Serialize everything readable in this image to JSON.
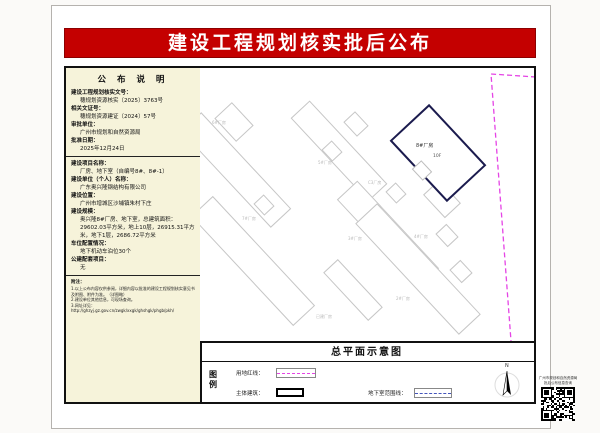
{
  "page": {
    "title": "建设工程规划核实批后公布"
  },
  "colors": {
    "banner_red": "#c40000",
    "panel_beige": "#f6f3da",
    "boundary_magenta": "#e544e5",
    "subject_navy": "#1b1b4e",
    "basement_blue": "#4455bb"
  },
  "notice": {
    "header": "公 布 说 明",
    "f1_label": "建设工程规划核实文号：",
    "f1_value": "穗规划资源核实〔2025〕3763号",
    "f2_label": "相关文证号：",
    "f2_value": "穗规划资源建证〔2024〕57号",
    "f3_label": "审批单位：",
    "f3_value": "广州市规划和自然资源局",
    "f4_label": "批准日期：",
    "f4_value": "2025年12月24日",
    "f5_label": "建设项目名称：",
    "f5_value": "厂房、地下室（自编号8#、8#-1）",
    "f6_label": "建设单位（个人）名称：",
    "f6_value": "广东奥兴隆钢结构有限公司",
    "f7_label": "建设位置：",
    "f7_value": "广州市增城区沙埔镇朱村下庄",
    "f8_label": "建设规模：",
    "f8_value": "奥兴隆8#厂房、地下室，总建筑面积：29602.03平方米，地上10层，26915.31平方米，地下1层，2686.72平方米",
    "f9_label": "车位配置情况：",
    "f9_value": "地下机动车泊位30个",
    "f10_label": "公建配套项目：",
    "f10_value": "无",
    "notes_title": "附注：",
    "note1": "1.以上公布内容仅供参阅，详细内容以批准的建设工程规划核实意见书及附图、附件为准。（详图略）",
    "note2": "2.建设单位其他信息，可现场查询。",
    "note3": "3.网址详见：http://ghzyj.gz.gov.cn/zwgk/xxgk/ghshgk/phgb/pkh/"
  },
  "map": {
    "plan_title": "总平面示意图",
    "subject_name": "8#厂房",
    "subject_floors": "10F",
    "labels": [
      {
        "text": "6#厂房"
      },
      {
        "text": "5#厂房"
      },
      {
        "text": "C3厂房"
      },
      {
        "text": "7#厂房"
      },
      {
        "text": "3#厂房"
      },
      {
        "text": "4#厂房"
      },
      {
        "text": "2#厂房"
      },
      {
        "text": "已建厂房"
      }
    ]
  },
  "legend": {
    "title": "图例",
    "items": [
      {
        "label": "用地红线："
      },
      {
        "label": "主体建筑："
      },
      {
        "label": "地下室范围线："
      }
    ],
    "north_label": "N"
  },
  "qr": {
    "caption1": "广州市规划和自然资源局",
    "caption2": "批后公布信息查询"
  }
}
